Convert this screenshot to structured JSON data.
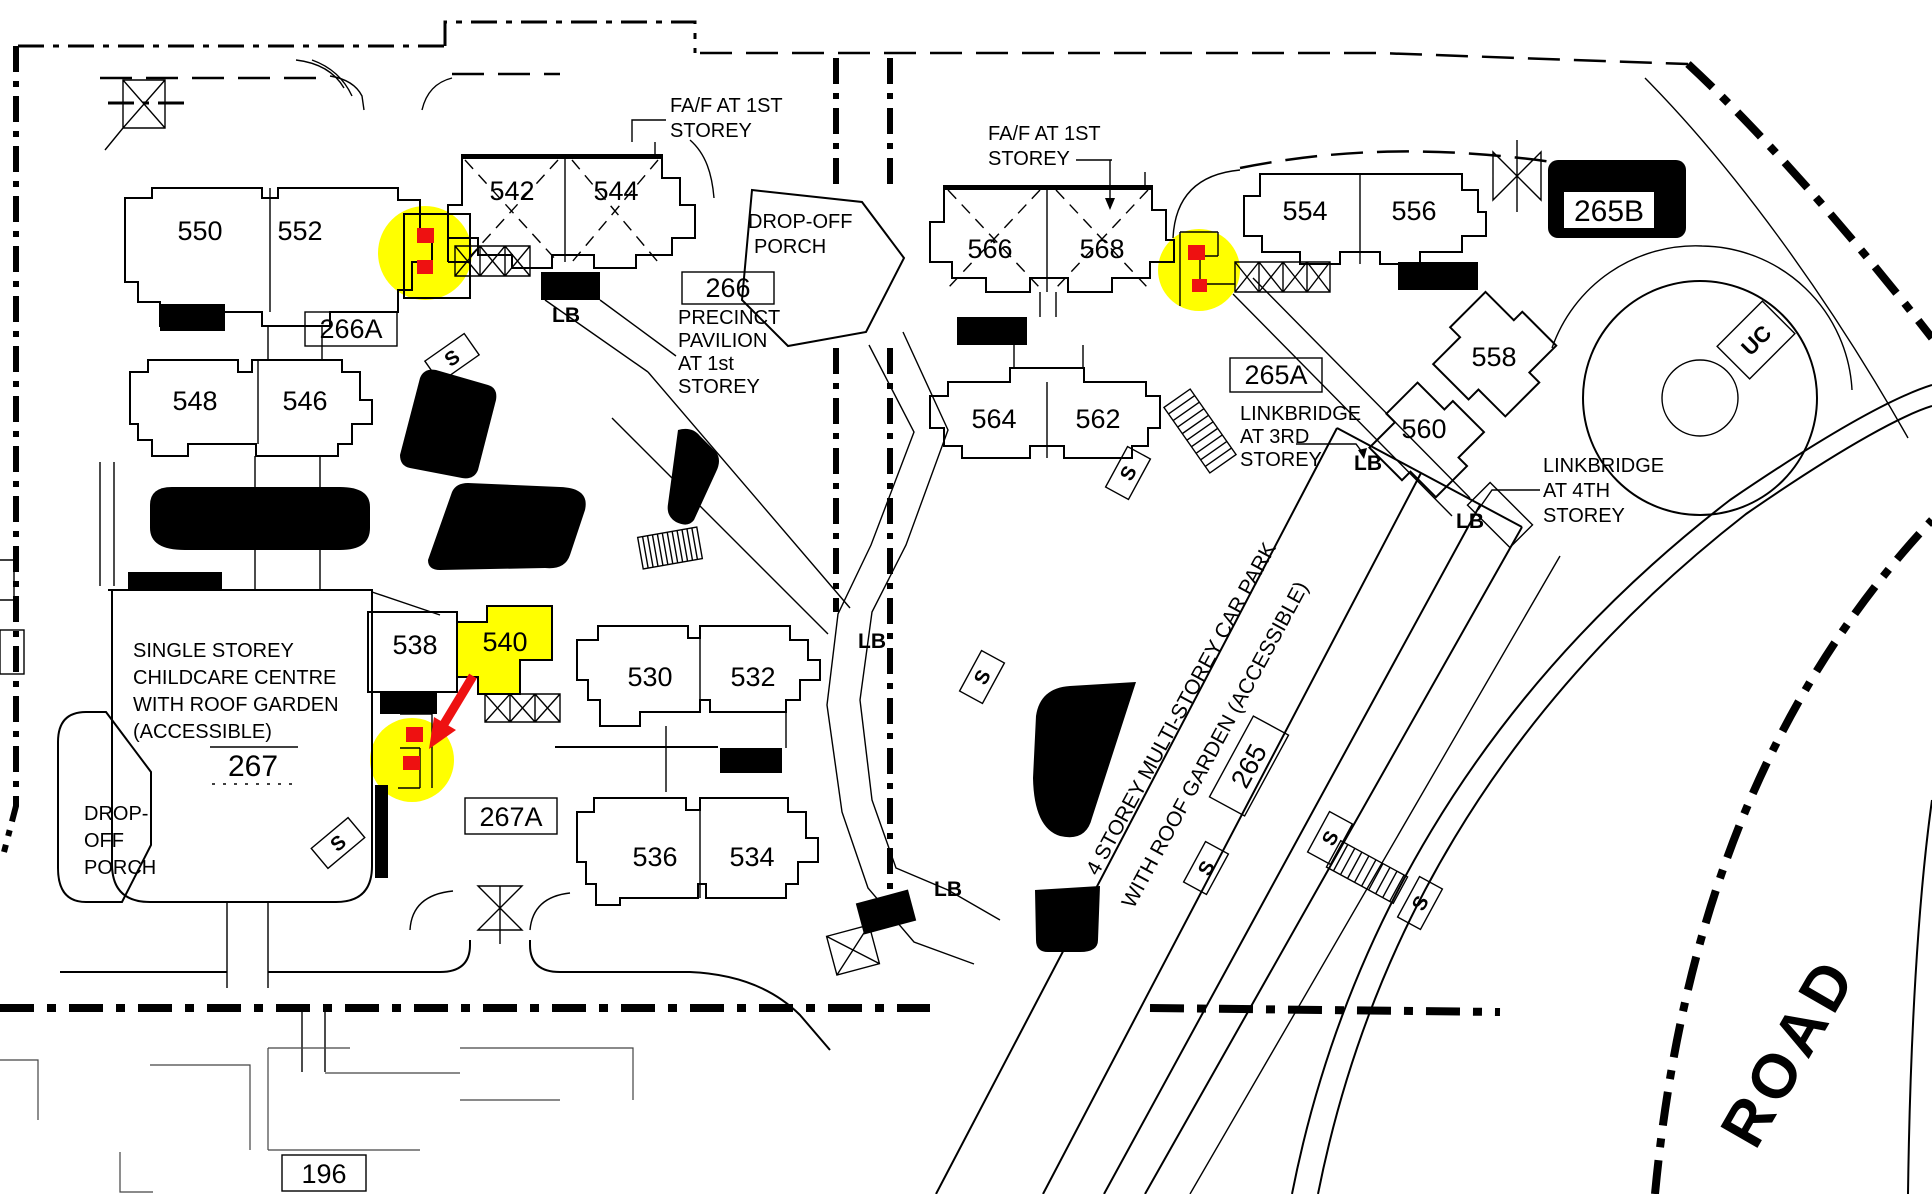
{
  "title": "Housing precinct site plan",
  "colors": {
    "highlight_yellow": "#ffff00",
    "marker_red": "#ee1111",
    "linework": "#000000"
  },
  "blocks": {
    "b550": "550",
    "b552": "552",
    "b542": "542",
    "b544": "544",
    "b548": "548",
    "b546": "546",
    "b538": "538",
    "b540": "540",
    "b530": "530",
    "b532": "532",
    "b536": "536",
    "b534": "534",
    "b566": "566",
    "b568": "568",
    "b564": "564",
    "b562": "562",
    "b554": "554",
    "b556": "556",
    "b558": "558",
    "b560": "560",
    "b196": "196"
  },
  "precincts": {
    "p266A": "266A",
    "p266": "266",
    "p265A": "265A",
    "p265B": "265B",
    "p267": "267",
    "p267A": "267A",
    "p265": "265"
  },
  "annotations": {
    "faf_line1": "FA/F AT 1ST",
    "faf_line2": "STOREY",
    "dropoff1": "DROP-OFF",
    "dropoff2": "PORCH",
    "dropoff_l1": "DROP-",
    "dropoff_l2": "OFF",
    "dropoff_l3": "PORCH",
    "pav1": "PRECINCT",
    "pav2": "PAVILION",
    "pav3": "AT 1st",
    "pav4": "STOREY",
    "lb3_1": "LINKBRIDGE",
    "lb3_2": "AT 3RD",
    "lb3_3": "STOREY",
    "lb4_1": "LINKBRIDGE",
    "lb4_2": "AT 4TH",
    "lb4_3": "STOREY",
    "cc1": "SINGLE STOREY",
    "cc2": "CHILDCARE CENTRE",
    "cc3": "WITH ROOF GARDEN",
    "cc4": "(ACCESSIBLE)",
    "cp1": "4 STOREY MULTI-STOREY CAR PARK",
    "cp2": "WITH ROOF GARDEN (ACCESSIBLE)",
    "road": "ROAD",
    "uc": "UC",
    "lb": "LB",
    "s": "S"
  }
}
